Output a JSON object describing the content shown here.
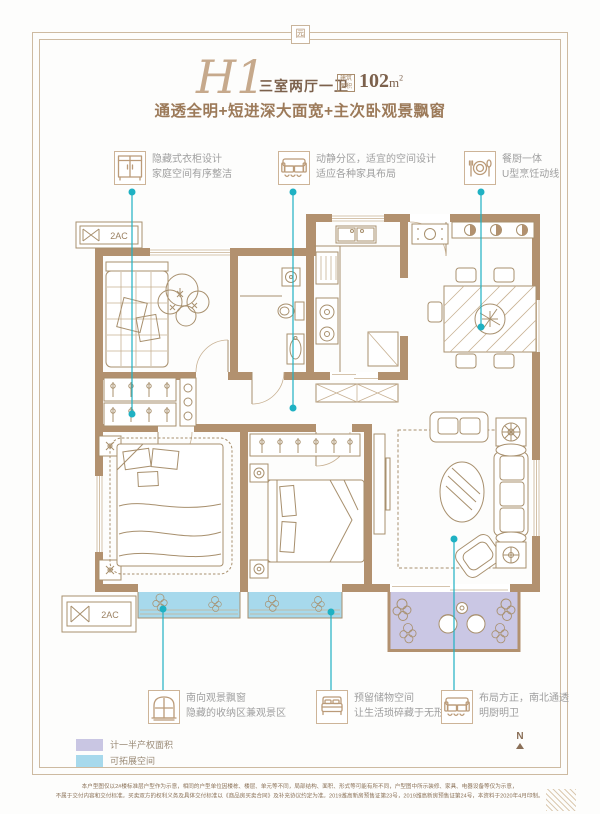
{
  "header": {
    "plan_code": "H1",
    "plan_type": "三室两厅一卫",
    "area_badge_top": "建筑",
    "area_badge_bottom": "面积",
    "area_number": "102",
    "area_unit": "m",
    "area_superscript": "2",
    "subtitle": "通透全明+短进深大面宽+主次卧观景飘窗",
    "seal_character": "园"
  },
  "callouts_top": [
    {
      "icon": "wardrobe-icon",
      "line1": "隐藏式衣柜设计",
      "line2": "家庭空间有序整洁"
    },
    {
      "icon": "sofa-icon",
      "line1": "动静分区，适宜的空间设计",
      "line2": "适应各种家具布局"
    },
    {
      "icon": "dining-icon",
      "line1": "餐厨一体",
      "line2": "U型烹饪动线"
    }
  ],
  "callouts_bottom": [
    {
      "icon": "window-icon",
      "line1": "南向观景飘窗",
      "line2": "隐藏的收纳区兼观景区"
    },
    {
      "icon": "bed-icon",
      "line1": "预留储物空间",
      "line2": "让生活琐碎藏于无形"
    },
    {
      "icon": "sofa-icon",
      "line1": "布局方正，南北通透",
      "line2": "明厨明卫"
    }
  ],
  "legend": {
    "items": [
      {
        "label": "计一半产权面积",
        "color": "#c9c6e3"
      },
      {
        "label": "可拓展空间",
        "color": "#a7d9ec"
      }
    ]
  },
  "plan": {
    "ac_label": "2AC",
    "compass_label": "N"
  },
  "colors": {
    "frame_tan": "#cdbaa1",
    "wall_brown": "#b2916f",
    "accent_teal": "#1fb1c3",
    "bay_window_blue": "#a7d9ec",
    "balcony_purple": "#cac7e4",
    "title_brown": "#7c614c",
    "subtitle_brown": "#9c7a59",
    "callout_gray": "#9f9f9f"
  },
  "footer": {
    "disclaimer_line1": "本户型图仅以2#楼标准层户型作为示意，相同的户型单位因楼栋、楼层、单元等不同，局部结构、面积、形式等可能有所不同，户型图中所示装修、家具、电器设备等仅为示意，",
    "disclaimer_line2": "不属于交付内容和交付标准。买卖双方的权利义务及具体交付标准以《商品房买卖合同》及补充协议约定为准。2019潍高新房预售证第23号，2019潍高新房预售证第24号，本资料于2020年4月印制。"
  }
}
